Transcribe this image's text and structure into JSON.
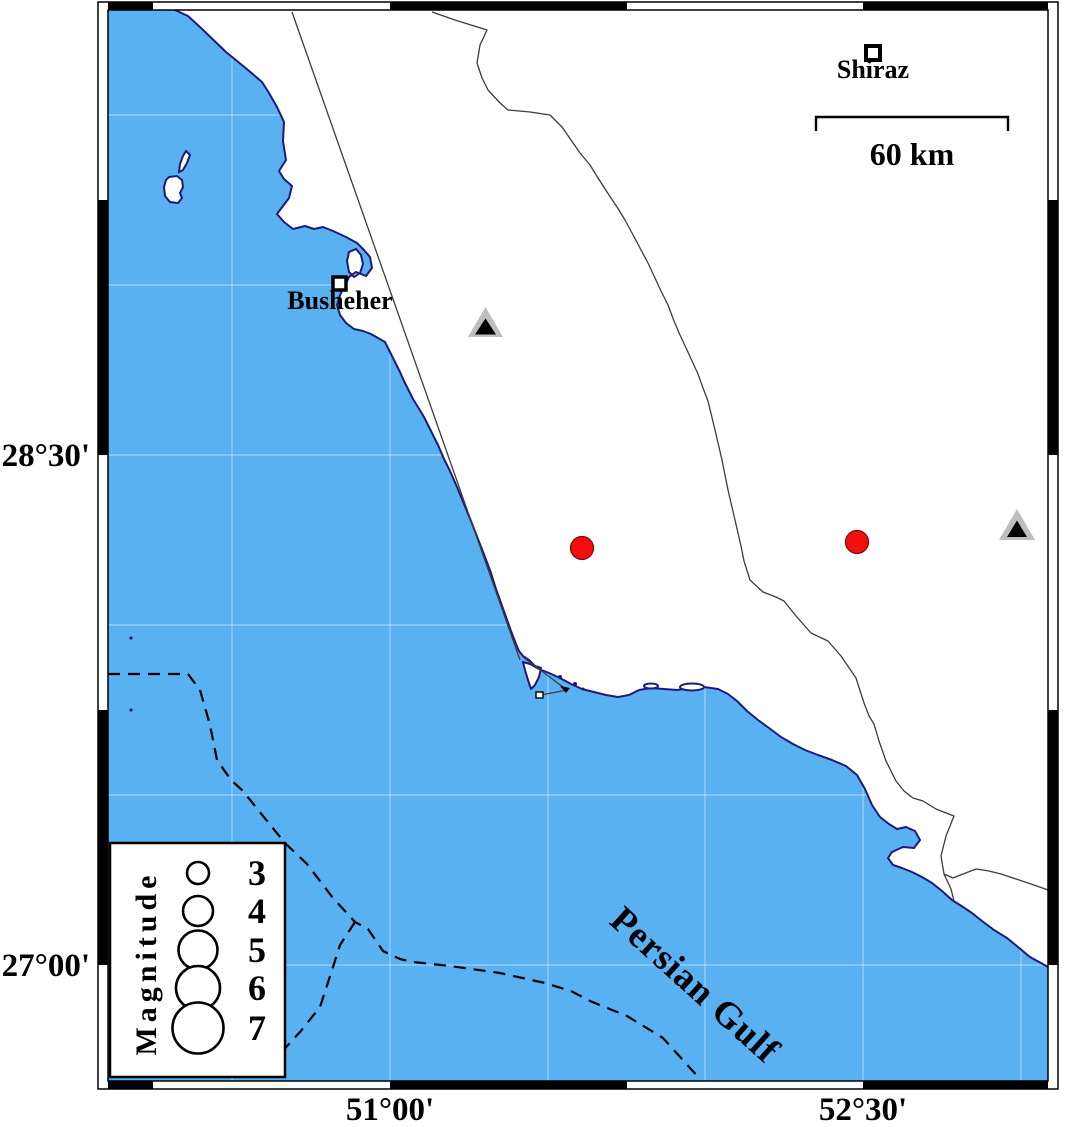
{
  "frame": {
    "axis_left": [
      {
        "label": "28°30'",
        "y": 466
      },
      {
        "label": "27°00'",
        "y": 976
      }
    ],
    "axis_bottom": [
      {
        "label": "51°00'",
        "x": 390
      },
      {
        "label": "52°30'",
        "x": 863
      }
    ]
  },
  "scalebar": {
    "label": "60 km",
    "path": "M816,131 L816,117 L1008,117 L1008,131",
    "label_x": 912,
    "label_y": 165
  },
  "cities": {
    "shiraz": {
      "name": "Shiraz",
      "label_x": 873,
      "label_y": 78,
      "sq_x": 866,
      "sq_y": 46,
      "sq_w": 14,
      "sq_h": 14
    },
    "busheher": {
      "name": "Busheher",
      "label_x": 340,
      "label_y": 309,
      "sq_x": 333,
      "sq_y": 277,
      "sq_w": 13,
      "sq_h": 13
    }
  },
  "sea": {
    "name": "Persian Gulf",
    "label_x": 695,
    "label_y": 997,
    "rotation": "rotate(42 695 985)"
  },
  "legend": {
    "title": "Magnitude",
    "title_x": 146,
    "title_y": 973,
    "title_rotation": "rotate(-90 146 963)",
    "box": {
      "x": 110,
      "y": 843,
      "w": 175,
      "h": 234
    },
    "circle_cx": 198,
    "label_x": 257,
    "items": [
      {
        "label": "3",
        "cy": 873,
        "r": 11,
        "ty": 885
      },
      {
        "label": "4",
        "cy": 911,
        "r": 15,
        "ty": 923
      },
      {
        "label": "5",
        "cy": 950,
        "r": 19.5,
        "ty": 962
      },
      {
        "label": "6",
        "cy": 988,
        "r": 22,
        "ty": 1000
      },
      {
        "label": "7",
        "cy": 1028,
        "r": 25.5,
        "ty": 1040
      }
    ]
  },
  "earthquakes": [
    {
      "cx": 582,
      "cy": 548,
      "r": 11.5
    },
    {
      "cx": 857,
      "cy": 542,
      "r": 11.5
    }
  ],
  "stations": [
    {
      "outer": "468,337 503,337 485.5,307",
      "inner": "475,334.5 496,334.5 485.5,318.5"
    },
    {
      "outer": "999,540 1035,540 1017,509",
      "inner": "1007,537 1027,537 1017,520.5"
    }
  ],
  "colors": {
    "sea": "#59B1F2",
    "coast": "#1C1C78",
    "land": "#FFFFFF",
    "quake": "#F01010",
    "quake_edge": "#7A0505",
    "station_gray": "#BEBEBE",
    "station_inner": "#000000"
  },
  "geometry": {
    "coast": "M175,10 L188,16 L201,28 L226,52 L248,70 L262,82 L269,93 L277,107 L284,122 L283,141 L286,160 L279,171 L284,179 L292,186 L289,198 L283,206 L277,214 L284,222 L293,229 L305,226 L314,229 L323,227 L333,231 L346,237 L357,243 L364,250 L370,257 L372,268 L366,276 L356,272 L349,277 L345,286 L340,295 L337,305 L340,315 L346,323 L354,329 L363,331 L371,334 L378,338 L385,342 L390,352 L395,362 L400,372 L404,381 L409,391 L413,399 L418,407 L424,417 L431,431 L438,445 L444,459 L450,471 L457,487 L464,504 L471,521 L478,539 L485,557 L491,573 L496,589 L501,603 L506,617 L511,631 L516,644 L519,651 L523,656 L529,660 L535,666 L541,668 L539,677 L535,685 L531,689 L528,680 L525,670 L523,662 L530,664 L539,669 L549,673 L560,678 L571,684 L582,689 L594,692 L606,695 L618,697 L629,695 L639,690 L651,688 L664,689 L677,690 L691,688 L704,687 L718,689 L728,694 L737,701 L747,711 L758,720 L769,728 L781,737 L793,744 L805,750 L818,755 L832,760 L846,766 L857,775 L865,789 L872,805 L880,817 L889,824 L897,829 L906,827 L915,831 L920,840 L914,848 L903,847 L892,852 L888,858 L893,865 L902,868 L912,872 L922,877 L932,883 L942,891 L952,900 L963,907 L972,913 L982,921 L994,930 L1007,938 L1018,947 L1030,957 L1041,963 L1048,967",
    "land": "M175,10 L188,16 L201,28 L226,52 L248,70 L262,82 L269,93 L277,107 L284,122 L283,141 L286,160 L279,171 L284,179 L292,186 L289,198 L283,206 L277,214 L284,222 L293,229 L305,226 L314,229 L323,227 L333,231 L346,237 L357,243 L364,250 L370,257 L372,268 L366,276 L356,272 L349,277 L345,286 L340,295 L337,305 L340,315 L346,323 L354,329 L363,331 L371,334 L378,338 L385,342 L390,352 L395,362 L400,372 L404,381 L409,391 L413,399 L418,407 L424,417 L431,431 L438,445 L444,459 L450,471 L457,487 L464,504 L471,521 L478,539 L485,557 L491,573 L496,589 L501,603 L506,617 L511,631 L516,644 L519,651 L523,656 L529,660 L535,666 L541,668 L539,677 L535,685 L531,689 L528,680 L525,670 L523,662 L530,664 L539,669 L549,673 L560,678 L571,684 L582,689 L594,692 L606,695 L618,697 L629,695 L639,690 L651,688 L664,689 L677,690 L691,688 L704,687 L718,689 L728,694 L737,701 L747,711 L758,720 L769,728 L781,737 L793,744 L805,750 L818,755 L832,760 L846,766 L857,775 L865,789 L872,805 L880,817 L889,824 L897,829 L906,827 L915,831 L920,840 L914,848 L903,847 L892,852 L888,858 L893,865 L902,868 L912,872 L922,877 L932,883 L942,891 L952,900 L963,907 L972,913 L982,921 L994,930 L1007,938 L1018,947 L1030,957 L1041,963 L1048,967 L1048,10 Z",
    "island_sliver": "M186,151 L190,155 L187,163 L183,170 L179,172 L180,164 L183,156 Z",
    "island_main": "M169,177 L177,176 L182,180 L183,187 L180,193 L182,198 L178,203 L170,202 L165,196 L164,187 L166,180 Z",
    "island_bay": "M349,252 L356,249 L361,255 L363,264 L360,273 L354,277 L349,272 L347,261 Z",
    "line_a": "M292,12 L520,660",
    "line_b": "M432,12 L455,20 L487,30 L480,45 L477,63 L482,78 L488,90 L500,103 L508,110 L530,112 L550,115 L562,127 L571,140 L580,153 L590,165 L598,178 L607,192 L617,207 L625,220 L632,233 L640,248 L648,263 L655,278 L661,291 L668,305 L674,321 L680,335 L687,350 L693,363 L698,374 L703,388 L708,401 L715,430 L722,460 L728,490 L735,520 L741,546 L744,561 L750,580 L763,592 L776,597 L784,601 L796,616 L811,633 L828,641 L841,656 L856,678 L864,703 L869,716 L874,724 L879,741 L886,761 L896,781 L904,791 L913,798 L923,801 L936,809 L954,816 L946,836 L941,856 L944,874 L953,878 L963,874 L976,869 L989,871 L1001,874 L1016,879 L1031,884 L1048,890",
    "line_b_branch": "M944,874 L951,889 L954,901",
    "causeway1": "M523,657 L567,690",
    "causeway2": "M567,690 L541,695",
    "arrow_blob": "560,686 570,688 566,693",
    "dash_main": "M108,674 L188,674 L200,690 L210,725 L217,760 L231,780 L243,791 L263,816 L285,843 L307,864 L333,898 L355,922 L368,929 L383,951 L400,959 L413,962 L450,966 L500,973 L545,983 L571,991 L590,1001 L627,1016 L663,1038 L700,1079",
    "dash_branch": "M355,922 L340,945 L333,967 L320,1007 L300,1032 L277,1057 L266,1076",
    "graticule": {
      "v": [
        232,
        390,
        548,
        705,
        863,
        1021
      ],
      "h": [
        115,
        285,
        455,
        625,
        795,
        965
      ]
    },
    "islets": [
      {
        "cx": 651,
        "cy": 686,
        "rx": 7,
        "ry": 2.5
      },
      {
        "cx": 692,
        "cy": 687,
        "rx": 12,
        "ry": 3.5
      }
    ],
    "specks": [
      {
        "cx": 131,
        "cy": 638,
        "r": 1.6
      },
      {
        "cx": 131,
        "cy": 710,
        "r": 1.6
      },
      {
        "cx": 560,
        "cy": 677,
        "r": 2
      },
      {
        "cx": 575,
        "cy": 684,
        "r": 2
      },
      {
        "cx": 583,
        "cy": 689,
        "r": 1.5
      }
    ]
  }
}
